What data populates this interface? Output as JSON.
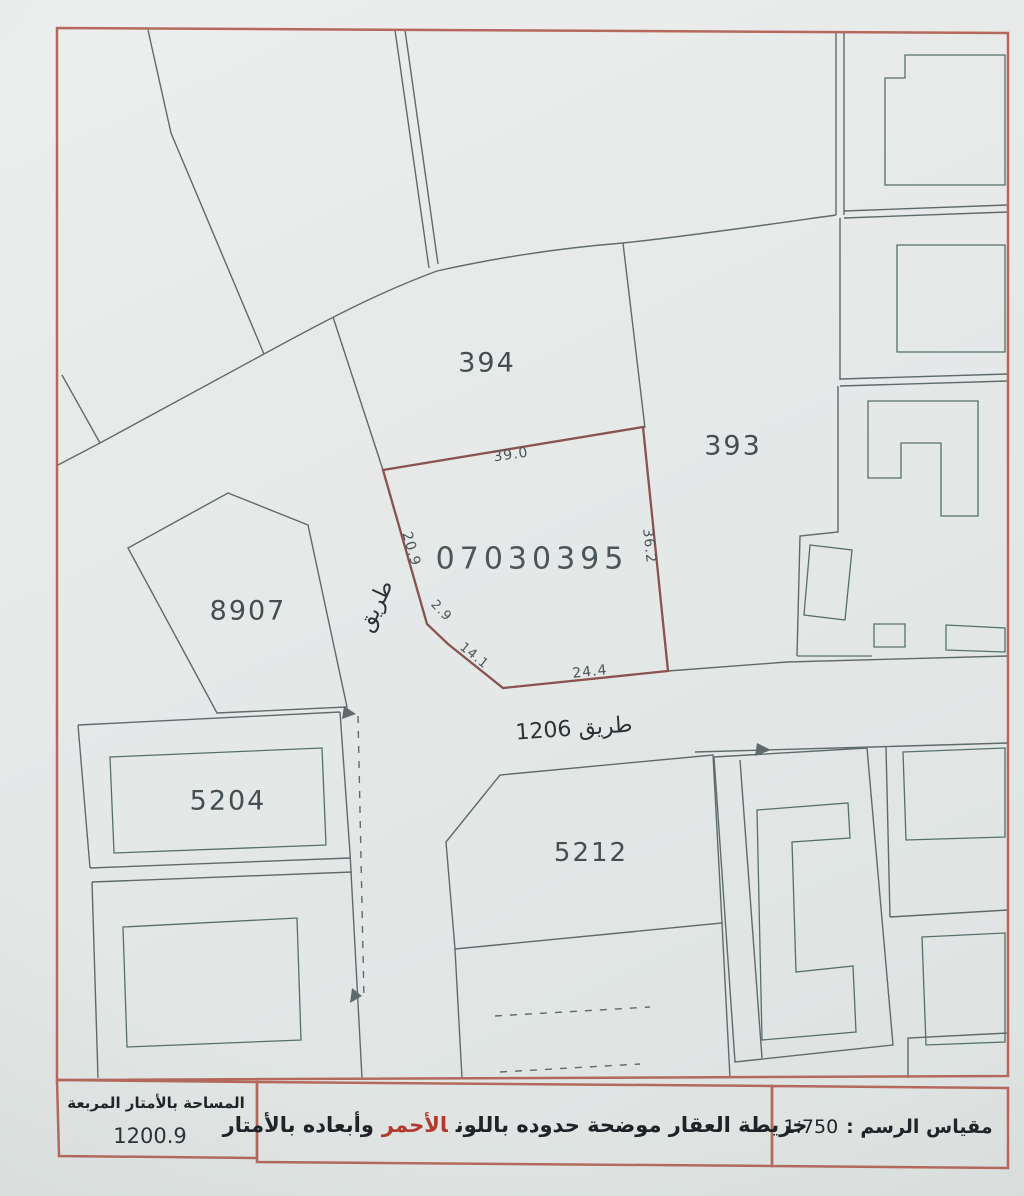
{
  "document": {
    "type_hint": "cadastral survey plot map (scanned)",
    "subject_plot_number": "07030395"
  },
  "map_labels": {
    "plot_number": "07030395",
    "parcel_394": "394",
    "parcel_393": "393",
    "parcel_8907": "8907",
    "parcel_5204": "5204",
    "parcel_5212": "5212",
    "road_name_vertical": "طريق",
    "road_1206": "طريق 1206"
  },
  "dimensions_meters": {
    "top": "39.0",
    "right": "36.2",
    "upper_left": "20.9",
    "bend": "2.9",
    "lower_left": "14.1",
    "bottom": "24.4"
  },
  "legend": {
    "area_label": "المساحة بالأمتار المربعة",
    "area_value": "1200.9",
    "title_before": "خريطة العقار موضحة حدوده باللون",
    "title_red_word": "الأحمر",
    "title_after": "وأبعاده بالأمتار",
    "scale_label": "مقياس الرسم :",
    "scale_value": "1:750"
  },
  "colors": {
    "frame": "#b4695c",
    "subject_plot_boundary": "#8a5250",
    "parcel_lines": "#5f6a6d",
    "building_outlines": "#547068",
    "red_text": "#b3392c",
    "paper": "#e5e9e8",
    "label_text": "#444f53"
  }
}
